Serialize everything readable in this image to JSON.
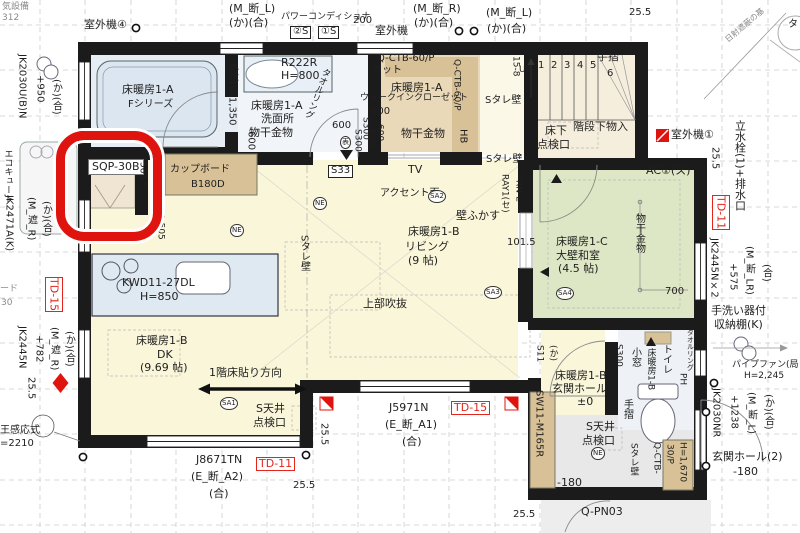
{
  "drawing": {
    "kind": "architectural-floor-plan",
    "highlight_color": "#e0140e",
    "room_fills": {
      "ldk": "#faf6da",
      "washitsu": "#dee7c5",
      "bath": "#e7edf4",
      "wic": "#ead9b8",
      "stair": "#f6eedd",
      "tataki": "#e8e8e8"
    }
  },
  "labels": [
    {
      "n": "text-partial-equipment",
      "t": "気設備",
      "x": 2,
      "y": 3,
      "s": 9,
      "cls": "gray"
    },
    {
      "n": "text-partial-number",
      "t": "312",
      "x": 2,
      "y": 14,
      "s": 9,
      "cls": "gray"
    },
    {
      "n": "label-outdoor-unit-4",
      "t": "室外機④",
      "x": 84,
      "y": 19,
      "s": 11
    },
    {
      "n": "code-m-dan-l",
      "t": "(M_断_L)",
      "x": 229,
      "y": 3,
      "s": 11
    },
    {
      "n": "code-ka-go",
      "t": "(か)(合)",
      "x": 229,
      "y": 17,
      "s": 11
    },
    {
      "n": "label-power-conditioner",
      "t": "パワーコンディショナ",
      "x": 281,
      "y": 13,
      "s": 9
    },
    {
      "n": "tag-2s",
      "t": "②S",
      "x": 290,
      "y": 26,
      "s": 10,
      "cls": "boxb"
    },
    {
      "n": "tag-1s",
      "t": "①S",
      "x": 318,
      "y": 26,
      "s": 10,
      "cls": "boxb"
    },
    {
      "n": "dim-200",
      "t": "200",
      "x": 353,
      "y": 16,
      "s": 10
    },
    {
      "n": "label-outdoor-unit",
      "t": "室外機",
      "x": 375,
      "y": 25,
      "s": 11
    },
    {
      "n": "code-m-dan-r",
      "t": "(M_断_R)",
      "x": 413,
      "y": 3,
      "s": 11
    },
    {
      "n": "code-ka-go",
      "t": "(か)(合)",
      "x": 414,
      "y": 17,
      "s": 11
    },
    {
      "n": "code-m-dan-l",
      "t": "(M_断_L)",
      "x": 486,
      "y": 7,
      "s": 11
    },
    {
      "n": "code-ka-go",
      "t": "(か)(合)",
      "x": 487,
      "y": 23,
      "s": 11
    },
    {
      "n": "dim-25-5",
      "t": "25.5",
      "x": 629,
      "y": 8,
      "s": 10
    },
    {
      "n": "label-sun-shade",
      "t": "日射遮蔽の基",
      "x": 724,
      "y": 38,
      "s": 8,
      "cls": "gray",
      "rot": -40
    },
    {
      "n": "text-partial-ta",
      "t": "タ",
      "x": 788,
      "y": 20,
      "s": 10
    },
    {
      "n": "label-outdoor-unit-1",
      "t": "室外機①",
      "x": 671,
      "y": 129,
      "s": 11
    },
    {
      "n": "dim-25-5",
      "t": "25.5",
      "x": 709,
      "y": 147,
      "s": 10,
      "v": true
    },
    {
      "n": "label-standpipe-drain",
      "t": "立水栓(1)+排水口",
      "x": 734,
      "y": 120,
      "s": 11,
      "v": true
    },
    {
      "n": "tag-td-11",
      "t": "TD-11",
      "x": 712,
      "y": 195,
      "s": 11,
      "v": true,
      "cls": "boxr"
    },
    {
      "n": "code-jk2445nx2",
      "t": "JK2445N×2",
      "x": 708,
      "y": 238,
      "s": 10,
      "v": true
    },
    {
      "n": "dim-575",
      "t": "+575",
      "x": 727,
      "y": 263,
      "s": 10,
      "v": true
    },
    {
      "n": "code-m-dan-lr",
      "t": "(M_断_LR)",
      "x": 743,
      "y": 246,
      "s": 10,
      "v": true
    },
    {
      "n": "code-go",
      "t": "(合)",
      "x": 760,
      "y": 264,
      "s": 10,
      "v": true
    },
    {
      "n": "label-handwash-shelf-1",
      "t": "手洗い器付",
      "x": 711,
      "y": 305,
      "s": 11
    },
    {
      "n": "label-handwash-shelf-2",
      "t": "収納棚(K)",
      "x": 714,
      "y": 319,
      "s": 11
    },
    {
      "n": "label-pipe-fan",
      "t": "パイプファン(局",
      "x": 732,
      "y": 361,
      "s": 9
    },
    {
      "n": "dim-h2245",
      "t": "H=2,245",
      "x": 744,
      "y": 372,
      "s": 9
    },
    {
      "n": "code-jk2030nr",
      "t": "JK2030NR",
      "x": 710,
      "y": 388,
      "s": 10,
      "v": true
    },
    {
      "n": "dim-1238",
      "t": "+1238",
      "x": 728,
      "y": 395,
      "s": 10,
      "v": true
    },
    {
      "n": "code-m-dan-l",
      "t": "(M_断_L)",
      "x": 745,
      "y": 392,
      "s": 10,
      "v": true
    },
    {
      "n": "code-ka-go",
      "t": "(か)(合)",
      "x": 762,
      "y": 394,
      "s": 10,
      "v": true
    },
    {
      "n": "label-genkan-hall-2",
      "t": "玄関ホール(2)",
      "x": 712,
      "y": 451,
      "s": 11
    },
    {
      "n": "dim-minus180",
      "t": "-180",
      "x": 733,
      "y": 466,
      "s": 11
    },
    {
      "n": "dim-25-5",
      "t": "25.5",
      "x": 513,
      "y": 510,
      "s": 10
    },
    {
      "n": "code-q-pn03",
      "t": "Q-PN03",
      "x": 581,
      "y": 506,
      "s": 11
    },
    {
      "n": "code-j8671tn",
      "t": "J8671TN",
      "x": 196,
      "y": 454,
      "s": 11
    },
    {
      "n": "code-e-dan-a2",
      "t": "(E_断_A2)",
      "x": 191,
      "y": 471,
      "s": 11
    },
    {
      "n": "code-go",
      "t": "(合)",
      "x": 209,
      "y": 488,
      "s": 11
    },
    {
      "n": "tag-td-11",
      "t": "TD-11",
      "x": 256,
      "y": 457,
      "s": 11,
      "cls": "boxr"
    },
    {
      "n": "dim-25-5",
      "t": "25.5",
      "x": 293,
      "y": 481,
      "s": 10
    },
    {
      "n": "dim-25-5",
      "t": "25.5",
      "x": 318,
      "y": 423,
      "s": 10,
      "v": true
    },
    {
      "n": "code-j5971n",
      "t": "J5971N",
      "x": 389,
      "y": 402,
      "s": 11
    },
    {
      "n": "code-e-dan-a1",
      "t": "(E_断_A1)",
      "x": 385,
      "y": 419,
      "s": 11
    },
    {
      "n": "code-go",
      "t": "(合)",
      "x": 402,
      "y": 436,
      "s": 11
    },
    {
      "n": "tag-td-15",
      "t": "TD-15",
      "x": 451,
      "y": 401,
      "s": 11,
      "cls": "boxr"
    },
    {
      "n": "code-jk2030ubn",
      "t": "JK2030U(B)N",
      "x": 16,
      "y": 54,
      "s": 10,
      "v": true
    },
    {
      "n": "dim-950",
      "t": "+950",
      "x": 34,
      "y": 75,
      "s": 10,
      "v": true
    },
    {
      "n": "code-ka-go",
      "t": "(か)(合)",
      "x": 50,
      "y": 79,
      "s": 10,
      "v": true
    },
    {
      "n": "label-ecocute",
      "t": "エコキュート",
      "x": 2,
      "y": 149,
      "s": 9,
      "v": true
    },
    {
      "n": "code-jk2471ak",
      "t": "JK2471A(K)",
      "x": 3,
      "y": 195,
      "s": 10,
      "v": true
    },
    {
      "n": "code-m-sha-r",
      "t": "(M_遮_R)",
      "x": 25,
      "y": 197,
      "s": 10,
      "v": true
    },
    {
      "n": "code-ka-go",
      "t": "(か)(合)",
      "x": 40,
      "y": 201,
      "s": 10,
      "v": true
    },
    {
      "n": "tag-td-15",
      "t": "TD-15",
      "x": 45,
      "y": 277,
      "s": 11,
      "v": true,
      "cls": "boxr"
    },
    {
      "n": "text-partial",
      "t": "ード",
      "x": 0,
      "y": 285,
      "s": 9,
      "cls": "gray"
    },
    {
      "n": "text-partial",
      "t": "30",
      "x": 1,
      "y": 299,
      "s": 9,
      "cls": "gray"
    },
    {
      "n": "code-jk2445n",
      "t": "JK2445N",
      "x": 16,
      "y": 326,
      "s": 10,
      "v": true
    },
    {
      "n": "dim-782",
      "t": "+782",
      "x": 33,
      "y": 335,
      "s": 10,
      "v": true
    },
    {
      "n": "code-m-sha-r",
      "t": "(M_遮_R)",
      "x": 48,
      "y": 327,
      "s": 10,
      "v": true
    },
    {
      "n": "code-ka-go",
      "t": "(か)(合)",
      "x": 63,
      "y": 331,
      "s": 10,
      "v": true
    },
    {
      "n": "dim-25-5",
      "t": "25.5",
      "x": 25,
      "y": 377,
      "s": 10,
      "v": true
    },
    {
      "n": "label-sensor",
      "t": "王感応式",
      "x": 0,
      "y": 426,
      "s": 10
    },
    {
      "n": "dim-2210",
      "t": "=2210",
      "x": 0,
      "y": 439,
      "s": 10
    },
    {
      "n": "label-floorheat-1a-bath",
      "t": "床暖房1-A",
      "x": 122,
      "y": 84,
      "s": 11
    },
    {
      "n": "label-bath-series",
      "t": "Fシリーズ",
      "x": 128,
      "y": 100,
      "s": 10
    },
    {
      "n": "code-r222r",
      "t": "R222R",
      "x": 281,
      "y": 57,
      "s": 11
    },
    {
      "n": "dim-h800",
      "t": "H=800",
      "x": 281,
      "y": 70,
      "s": 11
    },
    {
      "n": "label-towel-ring",
      "t": "タオルリング",
      "x": 322,
      "y": 66,
      "s": 9,
      "v": true,
      "rot": 22
    },
    {
      "n": "label-faucet-h1350",
      "t": "水栓H=1,350",
      "x": 226,
      "y": 61,
      "s": 10,
      "v": true
    },
    {
      "n": "label-floorheat-1a-wash",
      "t": "床暖房1-A",
      "x": 251,
      "y": 100,
      "s": 11
    },
    {
      "n": "label-washroom",
      "t": "洗面所",
      "x": 261,
      "y": 113,
      "s": 11
    },
    {
      "n": "label-drying-hardware",
      "t": "物干金物",
      "x": 249,
      "y": 127,
      "s": 11
    },
    {
      "n": "dim-600",
      "t": "600",
      "x": 245,
      "y": 131,
      "s": 10,
      "v": true
    },
    {
      "n": "dim-600",
      "t": "600",
      "x": 332,
      "y": 121,
      "s": 10
    },
    {
      "n": "dim-s300",
      "t": "S300",
      "x": 352,
      "y": 129,
      "s": 9,
      "v": true
    },
    {
      "n": "dim-600",
      "t": "600",
      "x": 366,
      "y": 129,
      "s": 9,
      "v": true
    },
    {
      "n": "tag-omote",
      "t": "表",
      "x": 340,
      "y": 136,
      "s": 9,
      "cls": "circ"
    },
    {
      "n": "code-q-ctb-60p",
      "t": "Q-CTB-60/P",
      "x": 377,
      "y": 54,
      "s": 10
    },
    {
      "n": "label-cut",
      "t": "カット",
      "x": 372,
      "y": 66,
      "s": 10
    },
    {
      "n": "label-floorheat-1a-wic",
      "t": "床暖房1-A",
      "x": 391,
      "y": 82,
      "s": 11
    },
    {
      "n": "label-walk-in-closet",
      "t": "ウォークインクローゼット",
      "x": 360,
      "y": 94,
      "s": 9
    },
    {
      "n": "dim-600",
      "t": "600",
      "x": 371,
      "y": 107,
      "s": 10
    },
    {
      "n": "label-drying-hardware",
      "t": "物干金物",
      "x": 401,
      "y": 128,
      "s": 11
    },
    {
      "n": "tag-hb",
      "t": "HB",
      "x": 457,
      "y": 129,
      "s": 10,
      "v": true
    },
    {
      "n": "code-q-ctb-60p",
      "t": "Q-CTB-60/P",
      "x": 451,
      "y": 59,
      "s": 9,
      "v": true
    },
    {
      "n": "dim-s300",
      "t": "S300",
      "x": 360,
      "y": 117,
      "s": 9,
      "v": true
    },
    {
      "n": "dim-600",
      "t": "600",
      "x": 374,
      "y": 124,
      "s": 9,
      "v": true
    },
    {
      "n": "label-s-tare-wall",
      "t": "Sタレ壁",
      "x": 485,
      "y": 96,
      "s": 10
    },
    {
      "n": "label-s-tare-wall",
      "t": "Sタレ壁",
      "x": 486,
      "y": 155,
      "s": 10
    },
    {
      "n": "label-stair-15-8",
      "t": "15-8",
      "x": 510,
      "y": 56,
      "s": 9,
      "v": true
    },
    {
      "n": "label-up",
      "t": "UP",
      "x": 519,
      "y": 66,
      "s": 9
    },
    {
      "n": "stair-num-1",
      "t": "1",
      "x": 538,
      "y": 61,
      "s": 10
    },
    {
      "n": "stair-num-2",
      "t": "2",
      "x": 551,
      "y": 61,
      "s": 10
    },
    {
      "n": "stair-num-3",
      "t": "3",
      "x": 564,
      "y": 61,
      "s": 10
    },
    {
      "n": "stair-num-4",
      "t": "4",
      "x": 577,
      "y": 61,
      "s": 10
    },
    {
      "n": "stair-num-5",
      "t": "5",
      "x": 590,
      "y": 61,
      "s": 10
    },
    {
      "n": "stair-num-6",
      "t": "6",
      "x": 607,
      "y": 69,
      "s": 10
    },
    {
      "n": "label-handrail",
      "t": "手摺",
      "x": 597,
      "y": 51,
      "s": 11
    },
    {
      "n": "label-underfloor-1",
      "t": "床下",
      "x": 545,
      "y": 125,
      "s": 11
    },
    {
      "n": "label-underfloor-2",
      "t": "点検口",
      "x": 537,
      "y": 139,
      "s": 11
    },
    {
      "n": "label-under-stair-storage",
      "t": "階段下物入",
      "x": 573,
      "y": 121,
      "s": 11
    },
    {
      "n": "tag-ac1",
      "t": "AC①(ス)",
      "x": 646,
      "y": 165,
      "s": 11
    },
    {
      "n": "label-floorheat-1c",
      "t": "床暖房1-C",
      "x": 556,
      "y": 236,
      "s": 11
    },
    {
      "n": "label-washitsu",
      "t": "大壁和室",
      "x": 556,
      "y": 250,
      "s": 11
    },
    {
      "n": "label-washitsu-size",
      "t": "(4.5 帖)",
      "x": 558,
      "y": 263,
      "s": 11
    },
    {
      "n": "tag-sa4",
      "t": "SA4",
      "x": 556,
      "y": 287,
      "s": 9,
      "cls": "circ"
    },
    {
      "n": "label-drying-hardware",
      "t": "物干金物",
      "x": 633,
      "y": 213,
      "s": 10,
      "v": true
    },
    {
      "n": "dim-700",
      "t": "700",
      "x": 665,
      "y": 287,
      "s": 10
    },
    {
      "n": "dim-101-5",
      "t": "101.5",
      "x": 507,
      "y": 238,
      "s": 10
    },
    {
      "n": "label-wall-fukasu",
      "t": "壁ふかす",
      "x": 456,
      "y": 210,
      "s": 11
    },
    {
      "n": "code-ray1",
      "t": "RAY1(セ)",
      "x": 499,
      "y": 174,
      "s": 9,
      "v": true
    },
    {
      "n": "code-rn-l",
      "t": "RN-L",
      "x": 513,
      "y": 180,
      "s": 9,
      "v": true
    },
    {
      "n": "label-tv",
      "t": "TV",
      "x": 408,
      "y": 164,
      "s": 11
    },
    {
      "n": "label-accent-wall",
      "t": "アクセント面",
      "x": 380,
      "y": 189,
      "s": 10
    },
    {
      "n": "tag-sa2",
      "t": "SA2",
      "x": 428,
      "y": 190,
      "s": 9,
      "cls": "circ"
    },
    {
      "n": "tag-s33",
      "t": "S33",
      "x": 328,
      "y": 165,
      "s": 10,
      "cls": "boxb"
    },
    {
      "n": "tag-ne",
      "t": "NE",
      "x": 313,
      "y": 197,
      "s": 9,
      "cls": "circ"
    },
    {
      "n": "label-floorheat-1b-living",
      "t": "床暖房1-B",
      "x": 408,
      "y": 226,
      "s": 11
    },
    {
      "n": "label-living",
      "t": "リビング",
      "x": 405,
      "y": 241,
      "s": 11
    },
    {
      "n": "label-living-size",
      "t": "(9 帖)",
      "x": 408,
      "y": 255,
      "s": 11
    },
    {
      "n": "tag-sa3",
      "t": "SA3",
      "x": 484,
      "y": 286,
      "s": 9,
      "cls": "circ"
    },
    {
      "n": "label-open-above",
      "t": "上部吹抜",
      "x": 363,
      "y": 298,
      "s": 11
    },
    {
      "n": "tag-ne",
      "t": "NE",
      "x": 230,
      "y": 224,
      "s": 9,
      "cls": "circ"
    },
    {
      "n": "code-kwd11-27dl",
      "t": "KWD11-27DL",
      "x": 122,
      "y": 277,
      "s": 11
    },
    {
      "n": "dim-h850",
      "t": "H=850",
      "x": 140,
      "y": 291,
      "s": 11
    },
    {
      "n": "label-cupboard",
      "t": "カップボード",
      "x": 170,
      "y": 165,
      "s": 10
    },
    {
      "n": "code-b180d",
      "t": "B180D",
      "x": 191,
      "y": 180,
      "s": 10
    },
    {
      "n": "code-sqp-30b",
      "t": "SQP-30B",
      "x": 88,
      "y": 159,
      "s": 11,
      "cls": "wbox"
    },
    {
      "n": "dim-561-5",
      "t": "561.5",
      "x": 137,
      "y": 162,
      "s": 9,
      "v": true
    },
    {
      "n": "dim-1505",
      "t": "1,505",
      "x": 155,
      "y": 214,
      "s": 9,
      "v": true
    },
    {
      "n": "label-floorheat-1b-dk",
      "t": "床暖房1-B",
      "x": 136,
      "y": 335,
      "s": 11
    },
    {
      "n": "label-dk",
      "t": "DK",
      "x": 157,
      "y": 349,
      "s": 11
    },
    {
      "n": "label-dk-size",
      "t": "(9.69 帖)",
      "x": 140,
      "y": 362,
      "s": 11
    },
    {
      "n": "label-floor-direction",
      "t": "1階床貼り方向",
      "x": 209,
      "y": 367,
      "s": 11
    },
    {
      "n": "tag-sa1",
      "t": "SA1",
      "x": 220,
      "y": 397,
      "s": 9,
      "cls": "circ"
    },
    {
      "n": "label-s-ceiling-1",
      "t": "S天井",
      "x": 256,
      "y": 403,
      "s": 11
    },
    {
      "n": "label-s-ceiling-2",
      "t": "点検口",
      "x": 253,
      "y": 417,
      "s": 11
    },
    {
      "n": "label-s-tare-wall",
      "t": "Sタレ壁",
      "x": 298,
      "y": 235,
      "s": 10,
      "v": true
    },
    {
      "n": "tag-s11",
      "t": "S11",
      "x": 534,
      "y": 345,
      "s": 9,
      "v": true
    },
    {
      "n": "code-ka",
      "t": "(か)",
      "x": 547,
      "y": 345,
      "s": 9,
      "v": true
    },
    {
      "n": "label-floorheat-1b-genkan",
      "t": "床暖房1-B",
      "x": 555,
      "y": 370,
      "s": 11
    },
    {
      "n": "label-genkan-hall",
      "t": "玄関ホール",
      "x": 552,
      "y": 383,
      "s": 11
    },
    {
      "n": "dim-pm0",
      "t": "±0",
      "x": 577,
      "y": 396,
      "s": 11
    },
    {
      "n": "dim-s300",
      "t": "S300",
      "x": 613,
      "y": 344,
      "s": 9,
      "v": true
    },
    {
      "n": "label-small-window",
      "t": "小窓",
      "x": 629,
      "y": 347,
      "s": 10,
      "v": true
    },
    {
      "n": "label-floorheat-1b-toilet",
      "t": "床暖房1-B",
      "x": 645,
      "y": 348,
      "s": 9,
      "v": true
    },
    {
      "n": "label-toilet",
      "t": "トイレ",
      "x": 660,
      "y": 344,
      "s": 10,
      "v": true
    },
    {
      "n": "tag-ph",
      "t": "PH",
      "x": 677,
      "y": 373,
      "s": 9,
      "v": true
    },
    {
      "n": "label-towel-ring",
      "t": "タオルリング",
      "x": 686,
      "y": 329,
      "s": 7,
      "v": true
    },
    {
      "n": "label-handrail",
      "t": "手摺",
      "x": 621,
      "y": 399,
      "s": 10,
      "v": true
    },
    {
      "n": "label-s-ceiling-1",
      "t": "S天井",
      "x": 586,
      "y": 421,
      "s": 11
    },
    {
      "n": "label-s-ceiling-2",
      "t": "点検口",
      "x": 582,
      "y": 435,
      "s": 11
    },
    {
      "n": "tag-ne",
      "t": "NE",
      "x": 591,
      "y": 447,
      "s": 9,
      "cls": "circ"
    },
    {
      "n": "dim-minus180",
      "t": "-180",
      "x": 557,
      "y": 477,
      "s": 11
    },
    {
      "n": "code-sw11-m165r",
      "t": "SW11-M165R",
      "x": 533,
      "y": 390,
      "s": 10,
      "v": true
    },
    {
      "n": "label-s-tare-wall",
      "t": "Sタレ壁",
      "x": 628,
      "y": 443,
      "s": 9,
      "v": true
    },
    {
      "n": "code-q-ctb",
      "t": "Q-CTB-",
      "x": 651,
      "y": 442,
      "s": 9,
      "v": true
    },
    {
      "n": "code-30p",
      "t": "30/P",
      "x": 664,
      "y": 444,
      "s": 9,
      "v": true
    },
    {
      "n": "dim-h1670",
      "t": "H=1,670",
      "x": 677,
      "y": 442,
      "s": 9,
      "v": true
    }
  ]
}
